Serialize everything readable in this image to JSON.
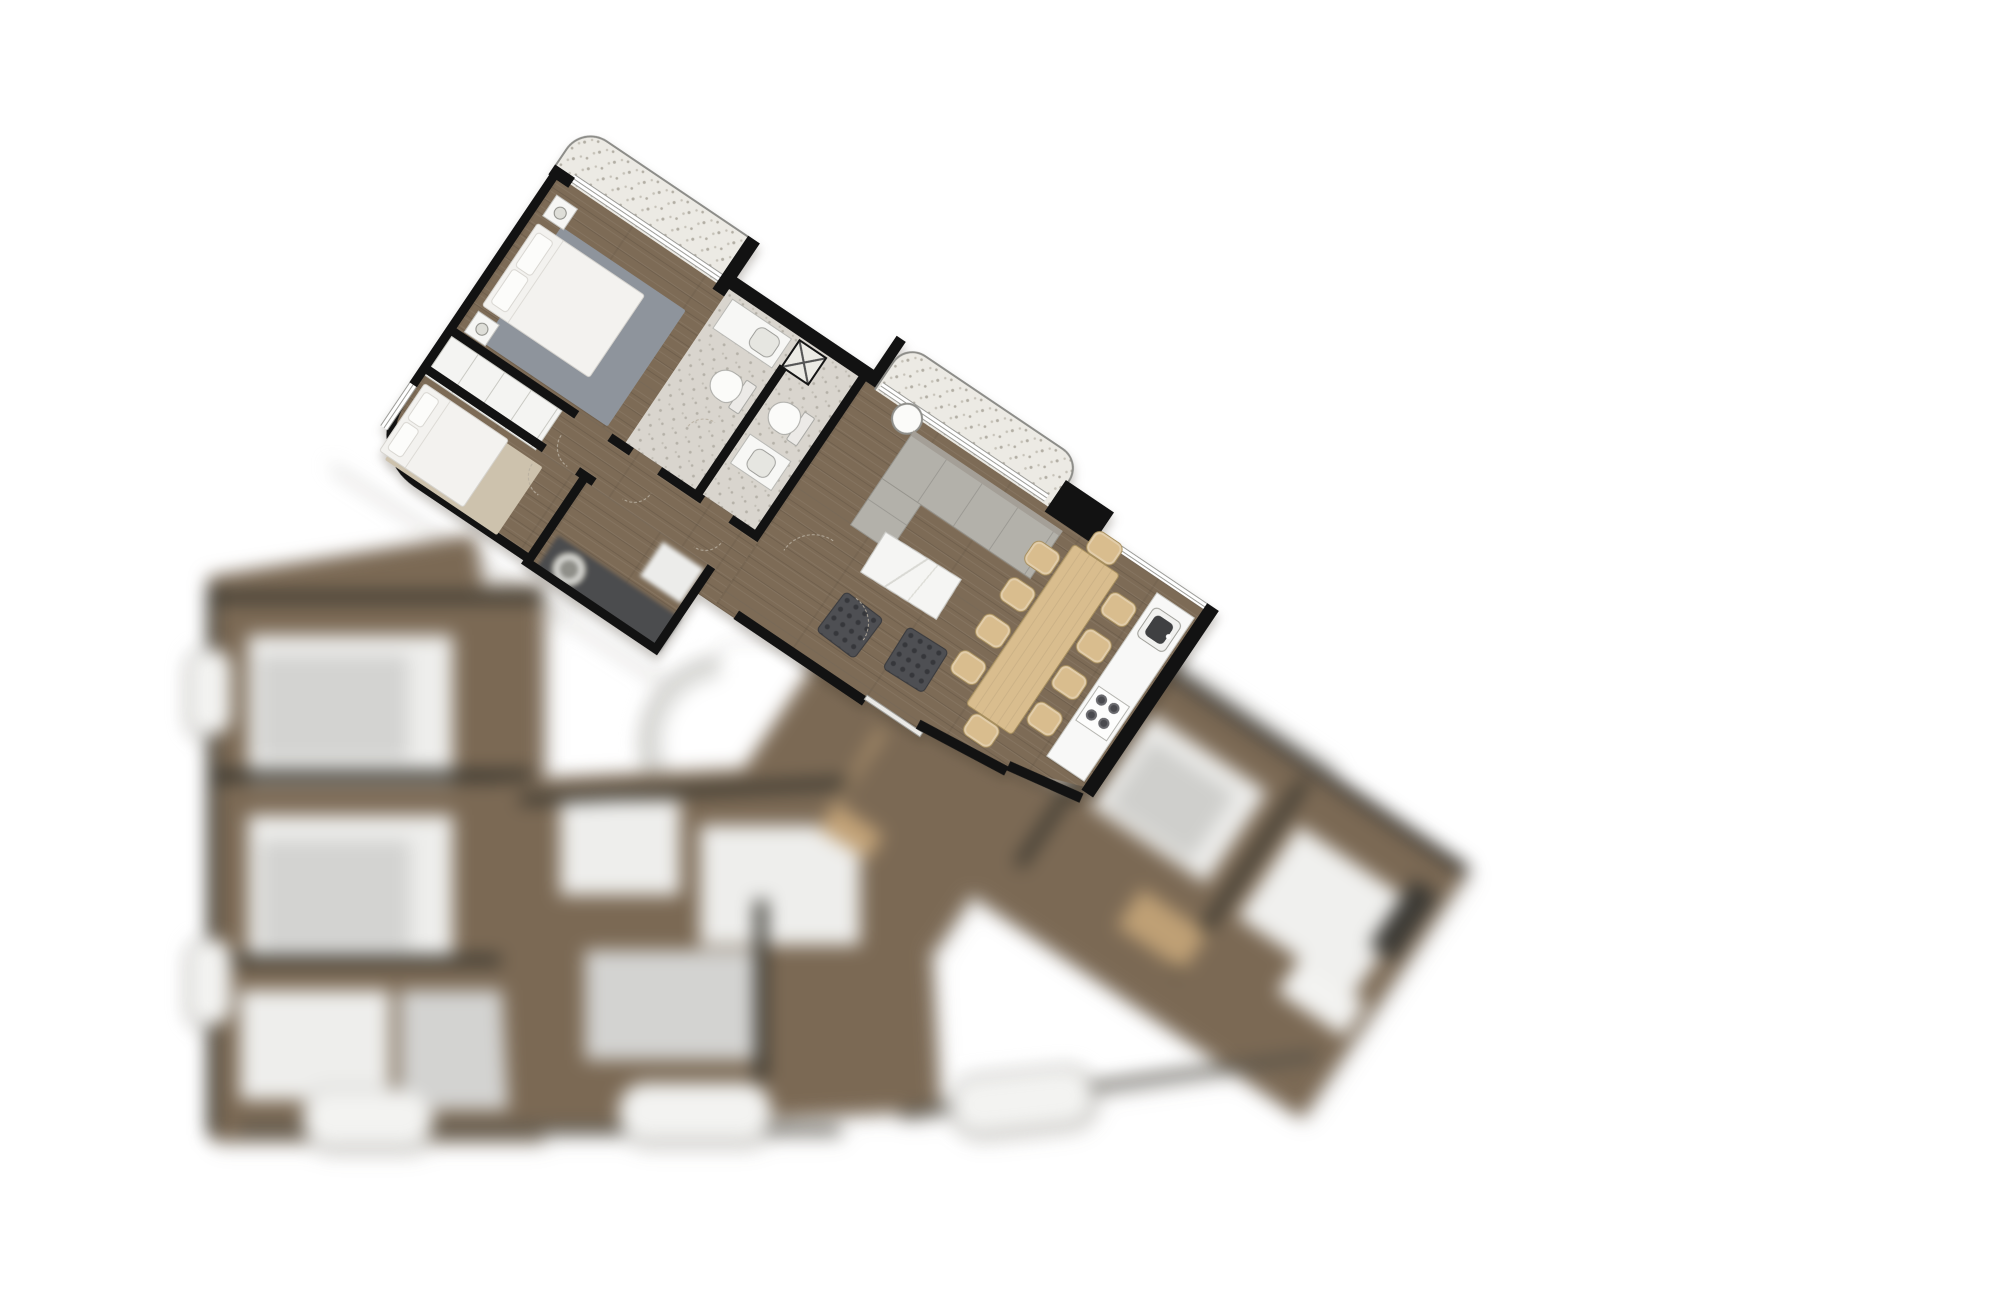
{
  "meta": {
    "kind": "architectural floor plan, top-down 3D render",
    "focus": "one apartment unit in sharp focus (upper left), remainder of the wedge-shaped floor plate out of focus",
    "rotation_deg": 34
  },
  "colors": {
    "background": "#ffffff",
    "wall": "#121212",
    "wood": "#7d6b56",
    "balcony_tile": "#eceae4",
    "speckle": "#b2aea4",
    "bath_tile": "#d9d5ce",
    "window": "#9c9c98",
    "linen": "#f3f2ef",
    "rug_gray": "#8e949c",
    "rug_tan": "#cdc2ad",
    "sofa": "#b3b1aa",
    "marble": "#f5f5f3",
    "armchair": "#4e4f53",
    "oak": "#d9bd8e",
    "oak_edge": "#a8905f",
    "counter": "#f8f8f7",
    "appliance_dark": "#4b4c4e",
    "arc": "#b7ae9f",
    "blur_brown": "#7b6954",
    "blur_white": "#eeeeec",
    "blur_gray": "#d3d3d1",
    "pill": "#f3f3f1",
    "pill_edge": "#a7a7a3",
    "tan": "#c2a277"
  },
  "sharp_unit": {
    "rooms": [
      "bedroom-1",
      "bedroom-2",
      "wardrobe",
      "hallway",
      "bathroom-1",
      "bathroom-2",
      "laundry",
      "living-room",
      "dining-area",
      "kitchen",
      "balcony-a",
      "balcony-b"
    ],
    "furniture_counts": {
      "double_beds": 2,
      "nightstands": 2,
      "table_lamps": 2,
      "toilets": 2,
      "washbasins": 2,
      "vent_shaft_x_marks": 1,
      "sofas": 1,
      "round_side_tables": 1,
      "marble_coffee_tables": 1,
      "dark_armchairs": 2,
      "dining_tables": 1,
      "dining_chairs": 10,
      "kitchen_sinks": 1,
      "cooktop_burners": 4,
      "washing_machines": 1,
      "area_rugs": 2,
      "door_swing_arcs": 7
    }
  },
  "blurred_region": {
    "contents": "additional apartment units with beds and furniture, circulation core with crossed lines, curved ramp ring, tan cabinets, perimeter balconies",
    "balcony_pills": 3,
    "side_bumps": 2
  }
}
